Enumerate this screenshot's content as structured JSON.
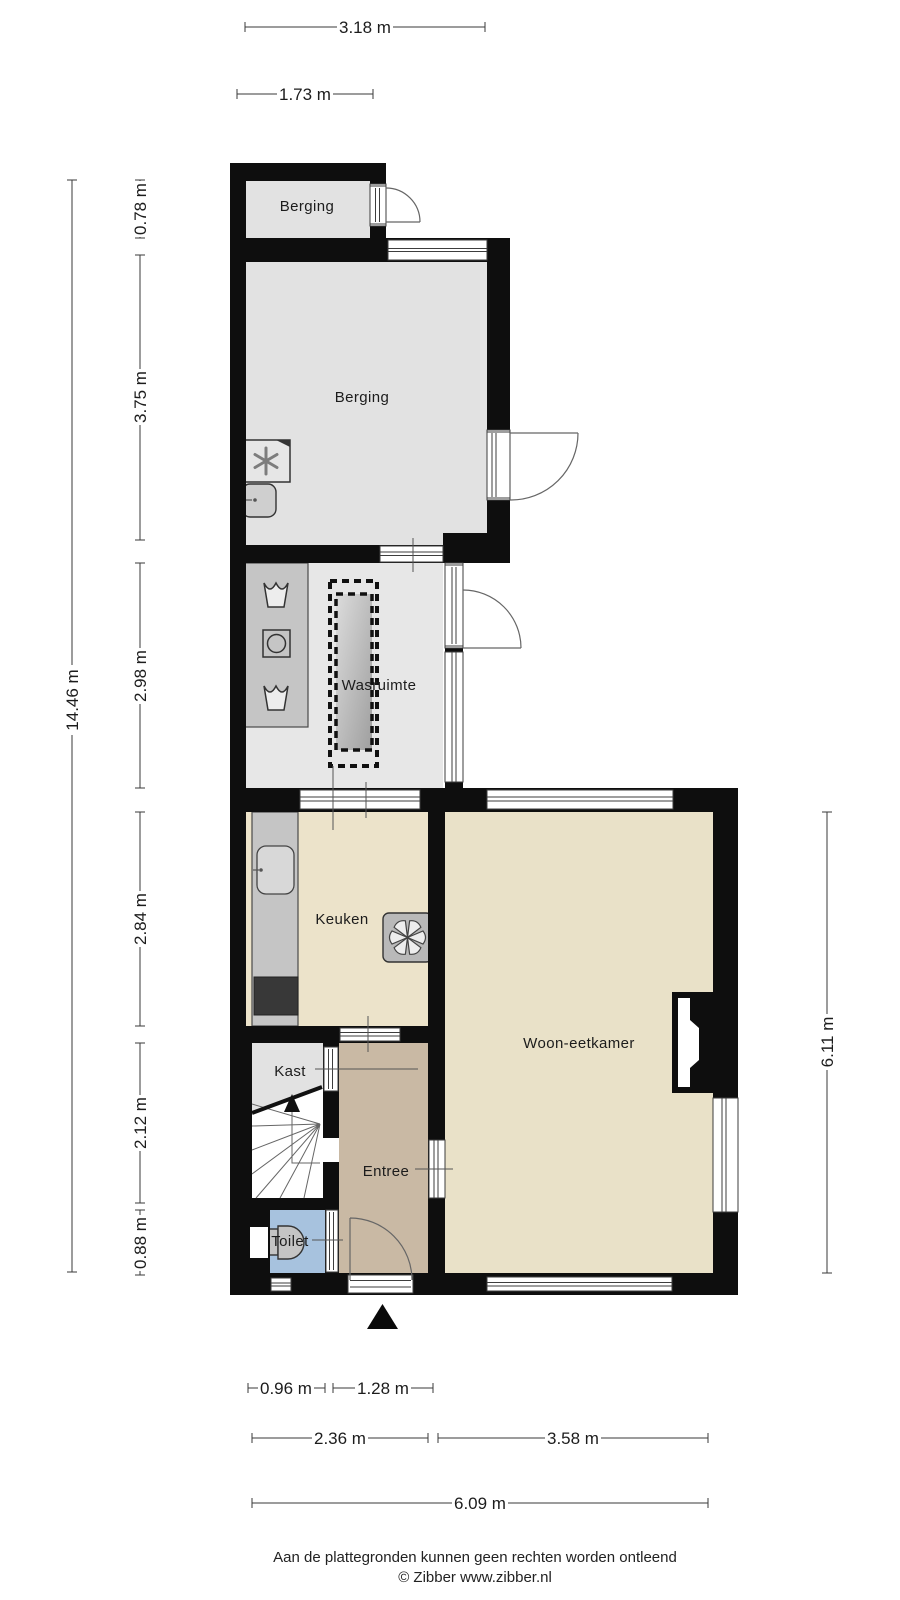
{
  "rooms": {
    "berging_top": "Berging",
    "berging": "Berging",
    "wasruimte": "Wasruimte",
    "keuken": "Keuken",
    "woon_eetkamer": "Woon-eetkamer",
    "kast": "Kast",
    "entree": "Entree",
    "toilet": "Toilet"
  },
  "dims": {
    "top_318": "3.18 m",
    "top_173": "1.73 m",
    "left_total": "14.46 m",
    "seg_078": "0.78 m",
    "seg_375": "3.75 m",
    "seg_298": "2.98 m",
    "seg_284": "2.84 m",
    "seg_212": "2.12 m",
    "seg_088": "0.88 m",
    "right_611": "6.11 m",
    "bot_096": "0.96 m",
    "bot_128": "1.28 m",
    "bot_236": "2.36 m",
    "bot_358": "3.58 m",
    "bot_609": "6.09 m"
  },
  "footer": {
    "line1": "Aan de plattegronden kunnen geen rechten worden ontleend",
    "line2": "© Zibber www.zibber.nl"
  },
  "icons": {
    "entrance_marker": "solid-triangle-up",
    "stairs_direction": "arrow-up",
    "ventilation_unit": "asterisk",
    "extractor_hob": "fan-blades",
    "washing_machine": "square-with-circle",
    "laundry_basket": "basket",
    "toilet_fixture": "toilet-top-view",
    "sink": "rounded-basin"
  },
  "colors": {
    "wall": "#0e0e0e",
    "floor_gray": "#e2e2e2",
    "floor_gray_light": "#e7e7e7",
    "floor_keuken": "#ece3ca",
    "floor_living": "#e9e1c8",
    "floor_entree": "#c9b9a4",
    "floor_toilet": "#a7c2de",
    "counter": "#c5c5c5",
    "appliance_dark": "#383838",
    "fixture": "#cfcfcf",
    "outline": "#3d3d3d",
    "dim_line": "#3a3a3a",
    "text": "#1c1c1c"
  }
}
